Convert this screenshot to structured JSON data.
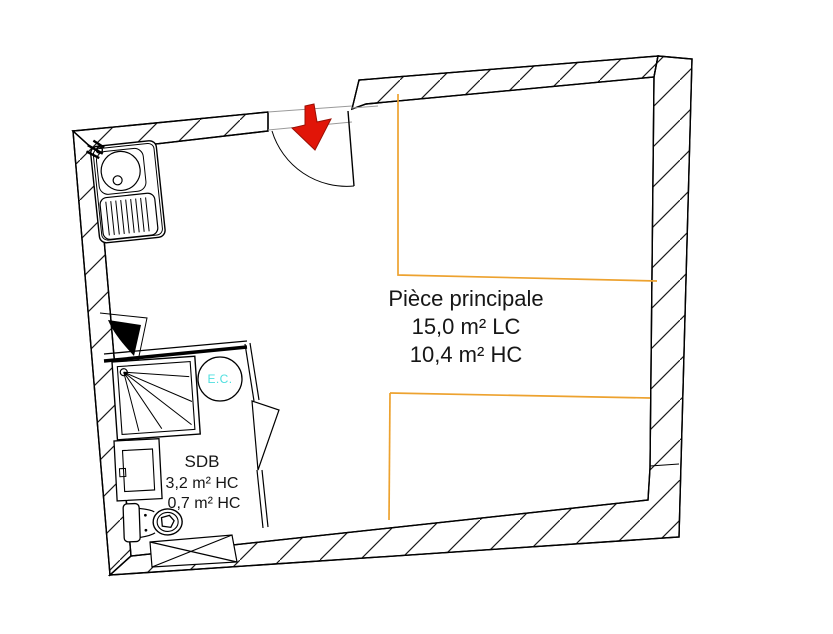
{
  "rooms": {
    "main_room": {
      "name": "Pièce principale",
      "area_line1": "15,0 m² LC",
      "area_line2": "10,4 m² HC"
    },
    "bathroom": {
      "name": "SDB",
      "area_line1": "3,2 m² HC",
      "area_line2": "0,7 m² HC"
    },
    "water_heater_label": "E.C."
  },
  "colors": {
    "zone_boundary_orange": "#eda22f",
    "entrance_arrow_red": "#e11508",
    "water_heater_cyan": "#4fdfdf",
    "wall_line_black": "#000000"
  }
}
